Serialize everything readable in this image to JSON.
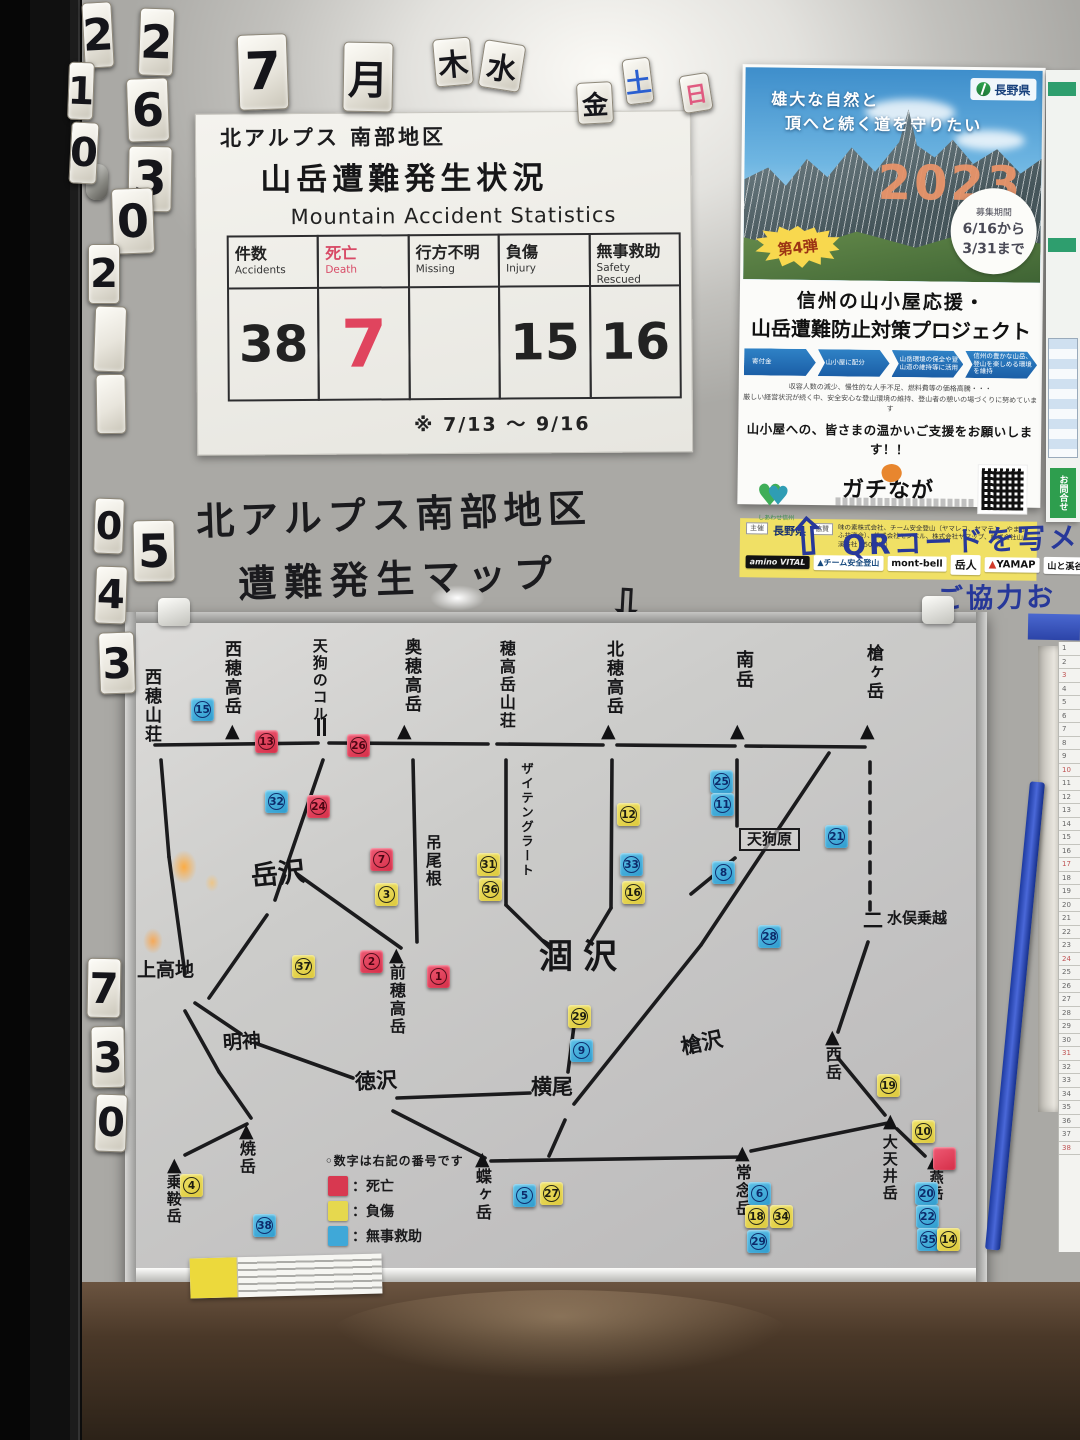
{
  "calendar": {
    "top_tiles": [
      {
        "t": "2",
        "x": 83,
        "y": 2,
        "w": 30,
        "h": 66,
        "fs": 44,
        "rot": -3
      },
      {
        "t": "2",
        "x": 139,
        "y": 8,
        "w": 35,
        "h": 68,
        "fs": 46,
        "rot": 2
      },
      {
        "t": "7",
        "x": 238,
        "y": 34,
        "w": 50,
        "h": 76,
        "fs": 52,
        "rot": -2
      },
      {
        "t": "月",
        "x": 343,
        "y": 42,
        "w": 50,
        "h": 70,
        "fs": 40,
        "rot": 1
      },
      {
        "t": "木",
        "x": 434,
        "y": 38,
        "w": 38,
        "h": 48,
        "fs": 30,
        "rot": -5
      },
      {
        "t": "水",
        "x": 481,
        "y": 42,
        "w": 42,
        "h": 48,
        "fs": 30,
        "rot": 9
      },
      {
        "t": "金",
        "x": 577,
        "y": 82,
        "w": 36,
        "h": 42,
        "fs": 26,
        "rot": -3
      },
      {
        "t": "土",
        "x": 624,
        "y": 58,
        "w": 28,
        "h": 46,
        "fs": 26,
        "rot": -7,
        "color": "#2a5fd0"
      },
      {
        "t": "日",
        "x": 681,
        "y": 74,
        "w": 30,
        "h": 38,
        "fs": 22,
        "rot": -9,
        "color": "#e05a80"
      }
    ],
    "left_tiles": [
      {
        "t": "1",
        "x": 68,
        "y": 62,
        "w": 26,
        "h": 58,
        "fs": 38,
        "rot": 2
      },
      {
        "t": "6",
        "x": 127,
        "y": 78,
        "w": 42,
        "h": 64,
        "fs": 46,
        "rot": -2
      },
      {
        "t": "0",
        "x": 70,
        "y": 122,
        "w": 28,
        "h": 62,
        "fs": 40,
        "rot": 3
      },
      {
        "t": "3",
        "x": 128,
        "y": 146,
        "w": 44,
        "h": 66,
        "fs": 48,
        "rot": 1
      },
      {
        "t": "0",
        "x": 112,
        "y": 188,
        "w": 42,
        "h": 66,
        "fs": 46,
        "rot": -2
      },
      {
        "t": "2",
        "x": 88,
        "y": 244,
        "w": 32,
        "h": 60,
        "fs": 40,
        "rot": 0
      },
      {
        "t": "",
        "x": 94,
        "y": 306,
        "w": 32,
        "h": 66,
        "fs": 30,
        "rot": 2
      },
      {
        "t": "",
        "x": 96,
        "y": 374,
        "w": 30,
        "h": 60,
        "fs": 30,
        "rot": -1
      },
      {
        "t": "0",
        "x": 94,
        "y": 498,
        "w": 30,
        "h": 56,
        "fs": 38,
        "rot": 2
      },
      {
        "t": "5",
        "x": 133,
        "y": 520,
        "w": 42,
        "h": 62,
        "fs": 46,
        "rot": -1
      },
      {
        "t": "4",
        "x": 95,
        "y": 566,
        "w": 32,
        "h": 58,
        "fs": 40,
        "rot": 2
      },
      {
        "t": "3",
        "x": 99,
        "y": 632,
        "w": 36,
        "h": 62,
        "fs": 42,
        "rot": -2
      },
      {
        "t": "7",
        "x": 87,
        "y": 958,
        "w": 34,
        "h": 60,
        "fs": 42,
        "rot": 1
      },
      {
        "t": "3",
        "x": 91,
        "y": 1026,
        "w": 34,
        "h": 62,
        "fs": 42,
        "rot": -1
      },
      {
        "t": "0",
        "x": 95,
        "y": 1094,
        "w": 32,
        "h": 58,
        "fs": 40,
        "rot": 2
      }
    ]
  },
  "stats_board": {
    "title_region": "北アルプス 南部地区",
    "title_main": "山岳遭難発生状況",
    "title_en": "Mountain Accident Statistics",
    "columns": [
      {
        "jp": "件数",
        "en": "Accidents",
        "value": "38",
        "highlight": false
      },
      {
        "jp": "死亡",
        "en": "Death",
        "value": "7",
        "highlight": true
      },
      {
        "jp": "行方不明",
        "en": "Missing",
        "value": "",
        "highlight": false
      },
      {
        "jp": "負傷",
        "en": "Injury",
        "value": "15",
        "highlight": false
      },
      {
        "jp": "無事救助",
        "en": "Safety Rescued",
        "value": "16",
        "highlight": false
      }
    ],
    "note": "※ 7/13 ～ 9/16",
    "accent_red": "#d84a66"
  },
  "poster": {
    "tagline1": "雄大な自然と",
    "tagline2": "頂へと続く道を守りたい",
    "pref_logo": "長野県",
    "year": "2023",
    "badge": "第4弾",
    "period_label": "募集期間",
    "period_from": "6/16から",
    "period_to": "3/31まで",
    "title1": "信州の山小屋応援・",
    "title2": "山岳遭難防止対策プロジェクト",
    "steps": [
      "寄付金",
      "山小屋に配分",
      "山岳環境の保全や登山道の維持等に活用",
      "信州の豊かな山岳、登山を楽しめる環境を維持"
    ],
    "body1": "収容人数の減少、慢性的な人手不足、燃料費等の価格高騰・・・",
    "body2": "厳しい経営状況が続く中、安全安心な登山環境の維持、登山者の憩いの場づくりに努めています",
    "appeal": "山小屋への、皆さまの温かいご支援をお願いします！！",
    "brand_heart_caption": "しあわせ信州",
    "brand_main": "ガチなが",
    "organizer_label": "主催",
    "organizer": "長野県",
    "support_label": "協賛",
    "support_text": "味の素株式会社、チーム安全登山（ヤマレコ、ヤマテン、やまきふ共済会）、株式会社モンベル、株式会社ヤマップ、株式会社山と溪谷社（50音順）",
    "logos": [
      {
        "label": "amino VITAL",
        "style": "amino"
      },
      {
        "label": "チーム安全登山",
        "style": "team",
        "prefix": "▲"
      },
      {
        "label": "mont-bell",
        "style": "montbell"
      },
      {
        "label": "岳人",
        "style": "gakujin"
      },
      {
        "label": "YAMAP",
        "style": "yamap",
        "prefix": "▲"
      },
      {
        "label": "山と溪谷社",
        "style": "yamakei"
      }
    ]
  },
  "wall_notes": {
    "qr_line1": "QRコードを写メ",
    "qr_line2": "ご協力お",
    "up_arrow": "⇧",
    "map_title1": "北アルプス南部地区",
    "map_title2": "遭難発生マップ",
    "down_arrow": "⇩"
  },
  "right_flyer": {
    "contact": "お問合せ"
  },
  "map_board": {
    "legend_heading": "◦数字は右記の番号です",
    "legend": [
      {
        "color": "#d83850",
        "label": "：死亡"
      },
      {
        "color": "#e6d84e",
        "label": "：負傷"
      },
      {
        "color": "#3fa8d8",
        "label": "：無事救助"
      }
    ],
    "locations": [
      {
        "name": "西穂山荘",
        "x": 16,
        "y": 56,
        "v": true,
        "fs": 17
      },
      {
        "name": "西穂高岳",
        "x": 96,
        "y": 28,
        "v": true,
        "fs": 17,
        "peak": [
          100,
          110
        ]
      },
      {
        "name": "天狗のコル",
        "x": 186,
        "y": 26,
        "v": true,
        "fs": 15,
        "col": [
          192,
          106
        ]
      },
      {
        "name": "奥穂高岳",
        "x": 276,
        "y": 26,
        "v": true,
        "fs": 17,
        "peak": [
          272,
          110
        ]
      },
      {
        "name": "吊尾根",
        "x": 298,
        "y": 222,
        "v": true,
        "fs": 16
      },
      {
        "name": "穂高岳山荘",
        "x": 372,
        "y": 28,
        "v": true,
        "fs": 16
      },
      {
        "name": "ザイテングラート",
        "x": 394,
        "y": 150,
        "v": true,
        "fs": 12.5
      },
      {
        "name": "北穂高岳",
        "x": 478,
        "y": 28,
        "v": true,
        "fs": 17,
        "peak": [
          476,
          110
        ]
      },
      {
        "name": "南岳",
        "x": 608,
        "y": 38,
        "v": true,
        "fs": 18,
        "peak": [
          605,
          110
        ]
      },
      {
        "name": "槍ヶ岳",
        "x": 738,
        "y": 32,
        "v": true,
        "fs": 17,
        "peak": [
          735,
          110
        ]
      },
      {
        "name": "岳沢",
        "x": 126,
        "y": 248,
        "v": false,
        "fs": 27,
        "rot": -6
      },
      {
        "name": "上高地",
        "x": 12,
        "y": 348,
        "v": false,
        "fs": 19
      },
      {
        "name": "明神",
        "x": 98,
        "y": 420,
        "v": false,
        "fs": 19,
        "rot": -4
      },
      {
        "name": "徳沢",
        "x": 230,
        "y": 458,
        "v": false,
        "fs": 21,
        "rot": -3
      },
      {
        "name": "横尾",
        "x": 406,
        "y": 464,
        "v": false,
        "fs": 21
      },
      {
        "name": "涸沢",
        "x": 414,
        "y": 326,
        "v": false,
        "fs": 34,
        "ls": 10
      },
      {
        "name": "前穂高岳",
        "x": 262,
        "y": 352,
        "v": true,
        "fs": 16,
        "peak": [
          264,
          334
        ]
      },
      {
        "name": "槍沢",
        "x": 556,
        "y": 420,
        "v": false,
        "fs": 21,
        "rot": -12
      },
      {
        "name": "天狗原",
        "x": 614,
        "y": 216,
        "v": false,
        "fs": 15,
        "boxed": true
      },
      {
        "name": "水俣乗越",
        "x": 762,
        "y": 298,
        "v": false,
        "fs": 15,
        "pass": [
          738,
          292
        ]
      },
      {
        "name": "西岳",
        "x": 698,
        "y": 434,
        "v": true,
        "fs": 16,
        "peak": [
          700,
          416
        ]
      },
      {
        "name": "大天井岳",
        "x": 756,
        "y": 522,
        "v": true,
        "fs": 15,
        "peak": [
          758,
          500
        ]
      },
      {
        "name": "常念岳",
        "x": 608,
        "y": 552,
        "v": true,
        "fs": 16,
        "peak": [
          610,
          532
        ]
      },
      {
        "name": "蝶ヶ岳",
        "x": 348,
        "y": 556,
        "v": true,
        "fs": 16,
        "peak": [
          350,
          538
        ]
      },
      {
        "name": "燕岳",
        "x": 802,
        "y": 558,
        "v": true,
        "fs": 14,
        "peak": [
          802,
          540
        ]
      },
      {
        "name": "焼岳",
        "x": 112,
        "y": 528,
        "v": true,
        "fs": 16,
        "peak": [
          114,
          510
        ]
      },
      {
        "name": "乗鞍岳",
        "x": 40,
        "y": 562,
        "v": true,
        "fs": 15,
        "peak": [
          42,
          544
        ]
      }
    ],
    "magnets": [
      {
        "n": "15",
        "c": "b",
        "x": 66,
        "y": 86
      },
      {
        "n": "13",
        "c": "r",
        "x": 130,
        "y": 118
      },
      {
        "n": "26",
        "c": "r",
        "x": 222,
        "y": 122
      },
      {
        "n": "32",
        "c": "b",
        "x": 140,
        "y": 178
      },
      {
        "n": "24",
        "c": "r",
        "x": 182,
        "y": 183
      },
      {
        "n": "7",
        "c": "r",
        "x": 245,
        "y": 236
      },
      {
        "n": "3",
        "c": "y",
        "x": 250,
        "y": 271
      },
      {
        "n": "31",
        "c": "y",
        "x": 352,
        "y": 241
      },
      {
        "n": "36",
        "c": "y",
        "x": 354,
        "y": 266
      },
      {
        "n": "12",
        "c": "y",
        "x": 492,
        "y": 191
      },
      {
        "n": "33",
        "c": "b",
        "x": 495,
        "y": 241
      },
      {
        "n": "16",
        "c": "y",
        "x": 497,
        "y": 269
      },
      {
        "n": "25",
        "c": "b",
        "x": 585,
        "y": 158
      },
      {
        "n": "11",
        "c": "b",
        "x": 586,
        "y": 181
      },
      {
        "n": "8",
        "c": "b",
        "x": 587,
        "y": 249
      },
      {
        "n": "21",
        "c": "b",
        "x": 700,
        "y": 213
      },
      {
        "n": "28",
        "c": "b",
        "x": 633,
        "y": 313
      },
      {
        "n": "37",
        "c": "y",
        "x": 167,
        "y": 343
      },
      {
        "n": "2",
        "c": "r",
        "x": 235,
        "y": 338
      },
      {
        "n": "1",
        "c": "r",
        "x": 302,
        "y": 353
      },
      {
        "n": "29",
        "c": "y",
        "x": 443,
        "y": 393
      },
      {
        "n": "9",
        "c": "b",
        "x": 445,
        "y": 427
      },
      {
        "n": "19",
        "c": "y",
        "x": 752,
        "y": 462
      },
      {
        "n": "10",
        "c": "y",
        "x": 787,
        "y": 508
      },
      {
        "n": "",
        "c": "r",
        "x": 808,
        "y": 535
      },
      {
        "n": "20",
        "c": "b",
        "x": 790,
        "y": 570
      },
      {
        "n": "22",
        "c": "b",
        "x": 791,
        "y": 593
      },
      {
        "n": "35",
        "c": "b",
        "x": 792,
        "y": 616
      },
      {
        "n": "14",
        "c": "y",
        "x": 812,
        "y": 616
      },
      {
        "n": "5",
        "c": "b",
        "x": 388,
        "y": 572
      },
      {
        "n": "27",
        "c": "y",
        "x": 415,
        "y": 570
      },
      {
        "n": "6",
        "c": "b",
        "x": 623,
        "y": 570
      },
      {
        "n": "18",
        "c": "y",
        "x": 620,
        "y": 593
      },
      {
        "n": "34",
        "c": "y",
        "x": 645,
        "y": 593
      },
      {
        "n": "29",
        "c": "b",
        "x": 622,
        "y": 618
      },
      {
        "n": "4",
        "c": "y",
        "x": 55,
        "y": 562
      },
      {
        "n": "38",
        "c": "b",
        "x": 128,
        "y": 602
      }
    ],
    "lines": [
      [
        30,
        133,
        193,
        131
      ],
      [
        204,
        131,
        363,
        132
      ],
      [
        372,
        132,
        478,
        133
      ],
      [
        492,
        133,
        610,
        134
      ],
      [
        621,
        134,
        740,
        135
      ],
      [
        36,
        148,
        44,
        245
      ],
      [
        44,
        245,
        60,
        362
      ],
      [
        198,
        148,
        150,
        288
      ],
      [
        142,
        303,
        84,
        386
      ],
      [
        172,
        262,
        276,
        336
      ],
      [
        288,
        148,
        292,
        330
      ],
      [
        381,
        148,
        381,
        293
      ],
      [
        381,
        293,
        425,
        336
      ],
      [
        487,
        148,
        486,
        296
      ],
      [
        486,
        296,
        462,
        336
      ],
      [
        450,
        406,
        443,
        460
      ],
      [
        612,
        148,
        612,
        214
      ],
      [
        610,
        246,
        566,
        282
      ],
      [
        704,
        141,
        576,
        333
      ],
      [
        576,
        333,
        449,
        492
      ],
      [
        745,
        150,
        745,
        298,
        1
      ],
      [
        743,
        330,
        713,
        420
      ],
      [
        713,
        446,
        760,
        503
      ],
      [
        366,
        549,
        616,
        545
      ],
      [
        626,
        539,
        763,
        511
      ],
      [
        772,
        517,
        800,
        544
      ],
      [
        268,
        499,
        360,
        546
      ],
      [
        70,
        391,
        116,
        422
      ],
      [
        130,
        431,
        228,
        466
      ],
      [
        272,
        486,
        405,
        481
      ],
      [
        440,
        508,
        424,
        544
      ],
      [
        60,
        399,
        94,
        460
      ],
      [
        94,
        460,
        126,
        506
      ],
      [
        122,
        512,
        60,
        543
      ]
    ]
  }
}
